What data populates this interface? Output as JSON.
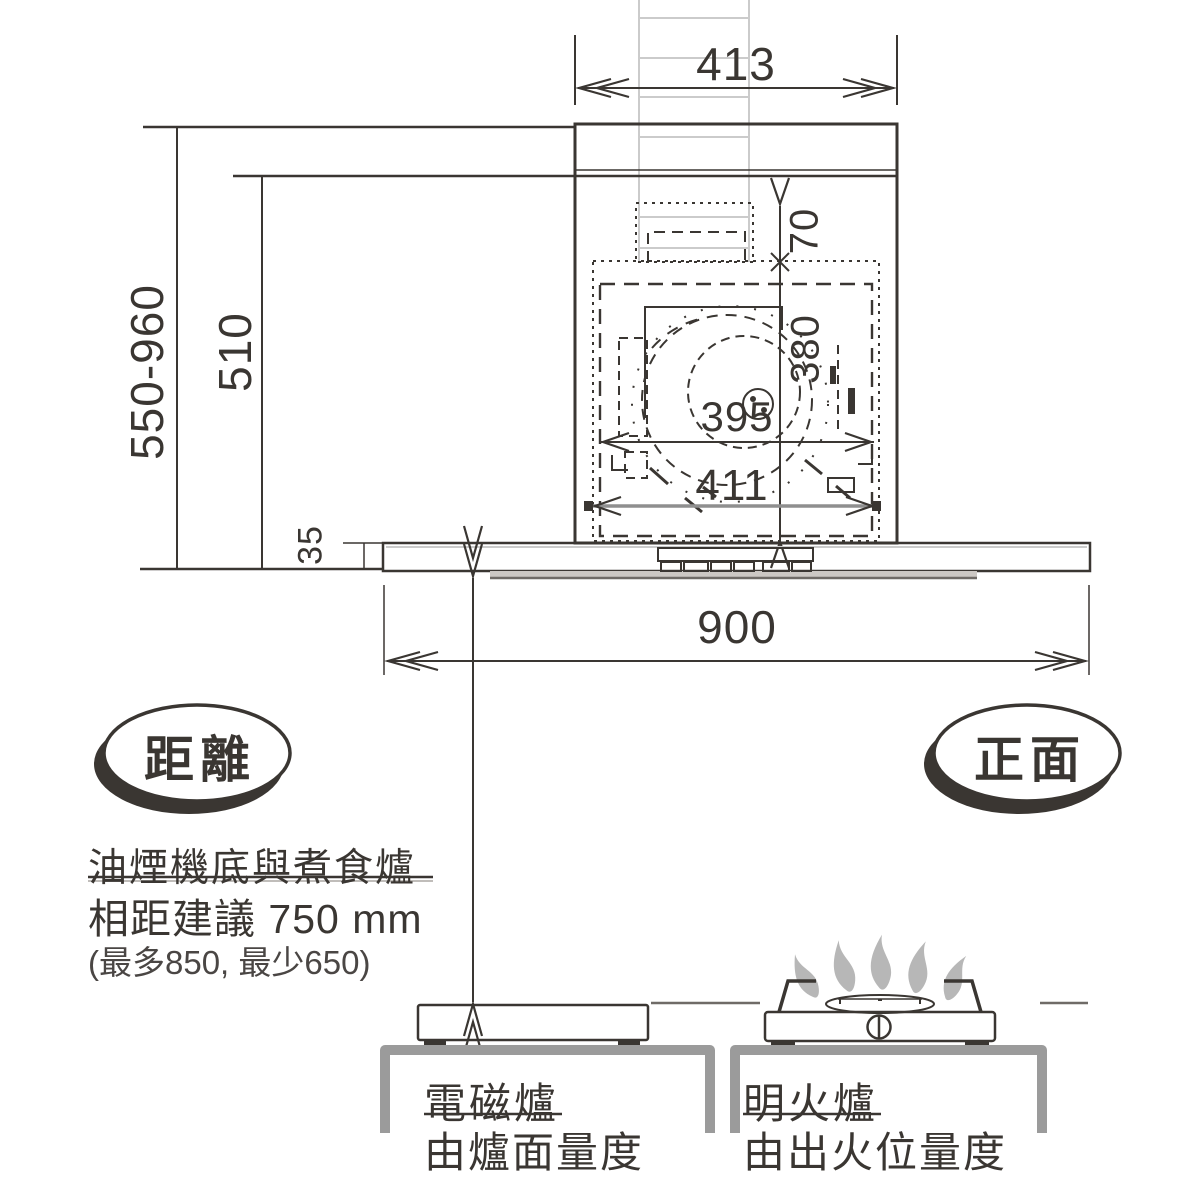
{
  "diagram": {
    "title_semantics": "range-hood-installation-diagram",
    "dims": {
      "top_width": "413",
      "total_height_range": "550-960",
      "body_height": "510",
      "canopy_thickness": "35",
      "duct_top_offset": "70",
      "inner_height": "380",
      "inner_width": "395",
      "opening_width": "411",
      "canopy_width": "900"
    },
    "badges": {
      "left": "距離",
      "right": "正面"
    },
    "note": {
      "line1": "油煙機底與煮食爐",
      "line2": "相距建議 750 mm",
      "line3": "(最多850, 最少650)"
    },
    "stoves": {
      "induction": {
        "title": "電磁爐",
        "subtitle": "由爐面量度"
      },
      "gas": {
        "title": "明火爐",
        "subtitle": "由出火位量度"
      }
    },
    "colors": {
      "line": "#3a3632",
      "dim_gray": "#8f8f8f",
      "bracket_gray": "#9b9b9b",
      "chimney_light": "#cbcbcb",
      "flame_gray": "#b7b7b7"
    }
  }
}
